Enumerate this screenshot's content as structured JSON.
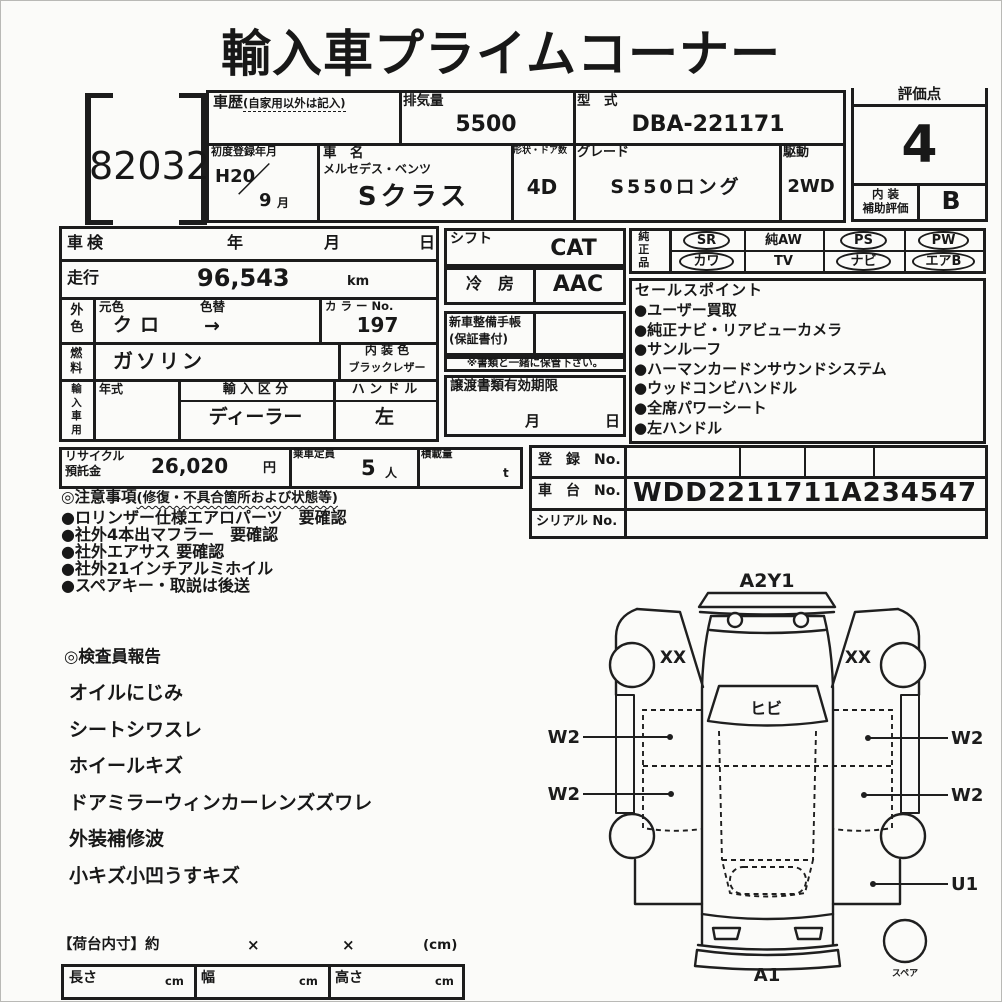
{
  "page": {
    "title": "輸入車プライムコーナー"
  },
  "lot": {
    "number": "82032"
  },
  "top": {
    "history_label": "車歴",
    "history_note": "(自家用以外は記入)",
    "displacement_label": "排気量",
    "displacement_value": "5500",
    "model_code_label": "型　式",
    "model_code_value": "DBA-221171",
    "first_reg_label": "初度登録年月",
    "first_reg_era": "H20",
    "first_reg_slash": "／",
    "first_reg_month": "9",
    "first_reg_month_unit": "月",
    "car_name_label": "車　名",
    "car_maker": "メルセデス・ベンツ",
    "car_model": "Sクラス",
    "body_doors_label": "形状・ドア数",
    "body_doors_value": "4D",
    "grade_label": "グレード",
    "grade_value": "S550ロング",
    "drive_label": "駆動",
    "drive_value": "2WD"
  },
  "score": {
    "label": "評価点",
    "value": "4",
    "interior_label_top": "内 装",
    "interior_label_bottom": "補助評価",
    "interior_value": "B"
  },
  "left": {
    "shaken_label": "車検",
    "year": "年",
    "month": "月",
    "day": "日",
    "mileage_label": "走行",
    "mileage_value": "96,543",
    "mileage_unit": "km",
    "ext_color_label": "外色",
    "base_color_label": "元色",
    "base_color_value": "クロ",
    "recolor_label": "色替",
    "recolor_arrow": "→",
    "color_no_label": "カ ラ ー No.",
    "color_no_value": "197",
    "fuel_label": "燃料",
    "fuel_value": "ガソリン",
    "int_color_label": "内 装 色",
    "int_color_value": "ブラックレザー",
    "import_label": "輸入車用",
    "year_model_label": "年式",
    "import_class_label": "輸 入 区 分",
    "import_class_value": "ディーラー",
    "handle_label": "ハ ン ド ル",
    "handle_value": "左"
  },
  "mid": {
    "shift_label": "シフト",
    "shift_value": "CAT",
    "ac_label": "冷　房",
    "ac_value": "AAC",
    "book_label_1": "新車整備手帳",
    "book_label_2": "(保証書付)",
    "keep_note": "※書類と一緒に保管下さい。",
    "transfer_label": "譲渡書類有効期限",
    "transfer_month": "月",
    "transfer_day": "日"
  },
  "junsei": {
    "label": "純正品",
    "items": [
      {
        "label": "SR",
        "circled": true
      },
      {
        "label": "純AW",
        "circled": false
      },
      {
        "label": "PS",
        "circled": true
      },
      {
        "label": "PW",
        "circled": true
      },
      {
        "label": "カワ",
        "circled": true
      },
      {
        "label": "TV",
        "circled": false
      },
      {
        "label": "ナビ",
        "circled": true
      },
      {
        "label": "エアB",
        "circled": true
      }
    ]
  },
  "sales": {
    "title": "セールスポイント",
    "bullet": "●",
    "items": [
      "ユーザー買取",
      "純正ナビ・リアビューカメラ",
      "サンルーフ",
      "ハーマンカードンサウンドシステム",
      "ウッドコンビハンドル",
      "全席パワーシート",
      "左ハンドル"
    ]
  },
  "recycle": {
    "label_1": "リサイクル",
    "label_2": "預託金",
    "value": "26,020",
    "unit": "円",
    "capacity_label": "乗車定員",
    "capacity_value": "5",
    "capacity_unit": "人",
    "load_label": "積載量",
    "load_unit": "t"
  },
  "reg": {
    "reg_label": "登　録　No.",
    "chassis_label": "車　台　No.",
    "chassis_value": "WDD2211711A234547",
    "serial_label": "シリアル No."
  },
  "notes": {
    "title": "◎注意事項",
    "title_note": "(修復・不具合箇所および状態等)",
    "bullet": "●",
    "items": [
      "ロリンザー仕様エアロパーツ　要確認",
      "社外4本出マフラー　要確認",
      "社外エアサス 要確認",
      "社外21インチアルミホイル",
      "スペアキー・取説は後送"
    ]
  },
  "inspector": {
    "title": "◎検査員報告",
    "items": [
      "オイルにじみ",
      "シートシワスレ",
      "ホイールキズ",
      "ドアミラーウィンカーレンズズワレ",
      "外装補修波",
      "小キズ小凹うすキズ"
    ]
  },
  "diagram": {
    "front_label": "A2Y1",
    "fender_left": "XX",
    "fender_right": "XX",
    "windshield_label": "ヒビ",
    "w2": "W2",
    "u1": "U1",
    "rear_label": "A1",
    "spare_label": "スペア"
  },
  "cargo": {
    "title": "【荷台内寸】約",
    "times1": "×",
    "times2": "×",
    "unit_note": "(cm)",
    "length_label": "長さ",
    "width_label": "幅",
    "height_label": "高さ",
    "unit": "cm"
  }
}
